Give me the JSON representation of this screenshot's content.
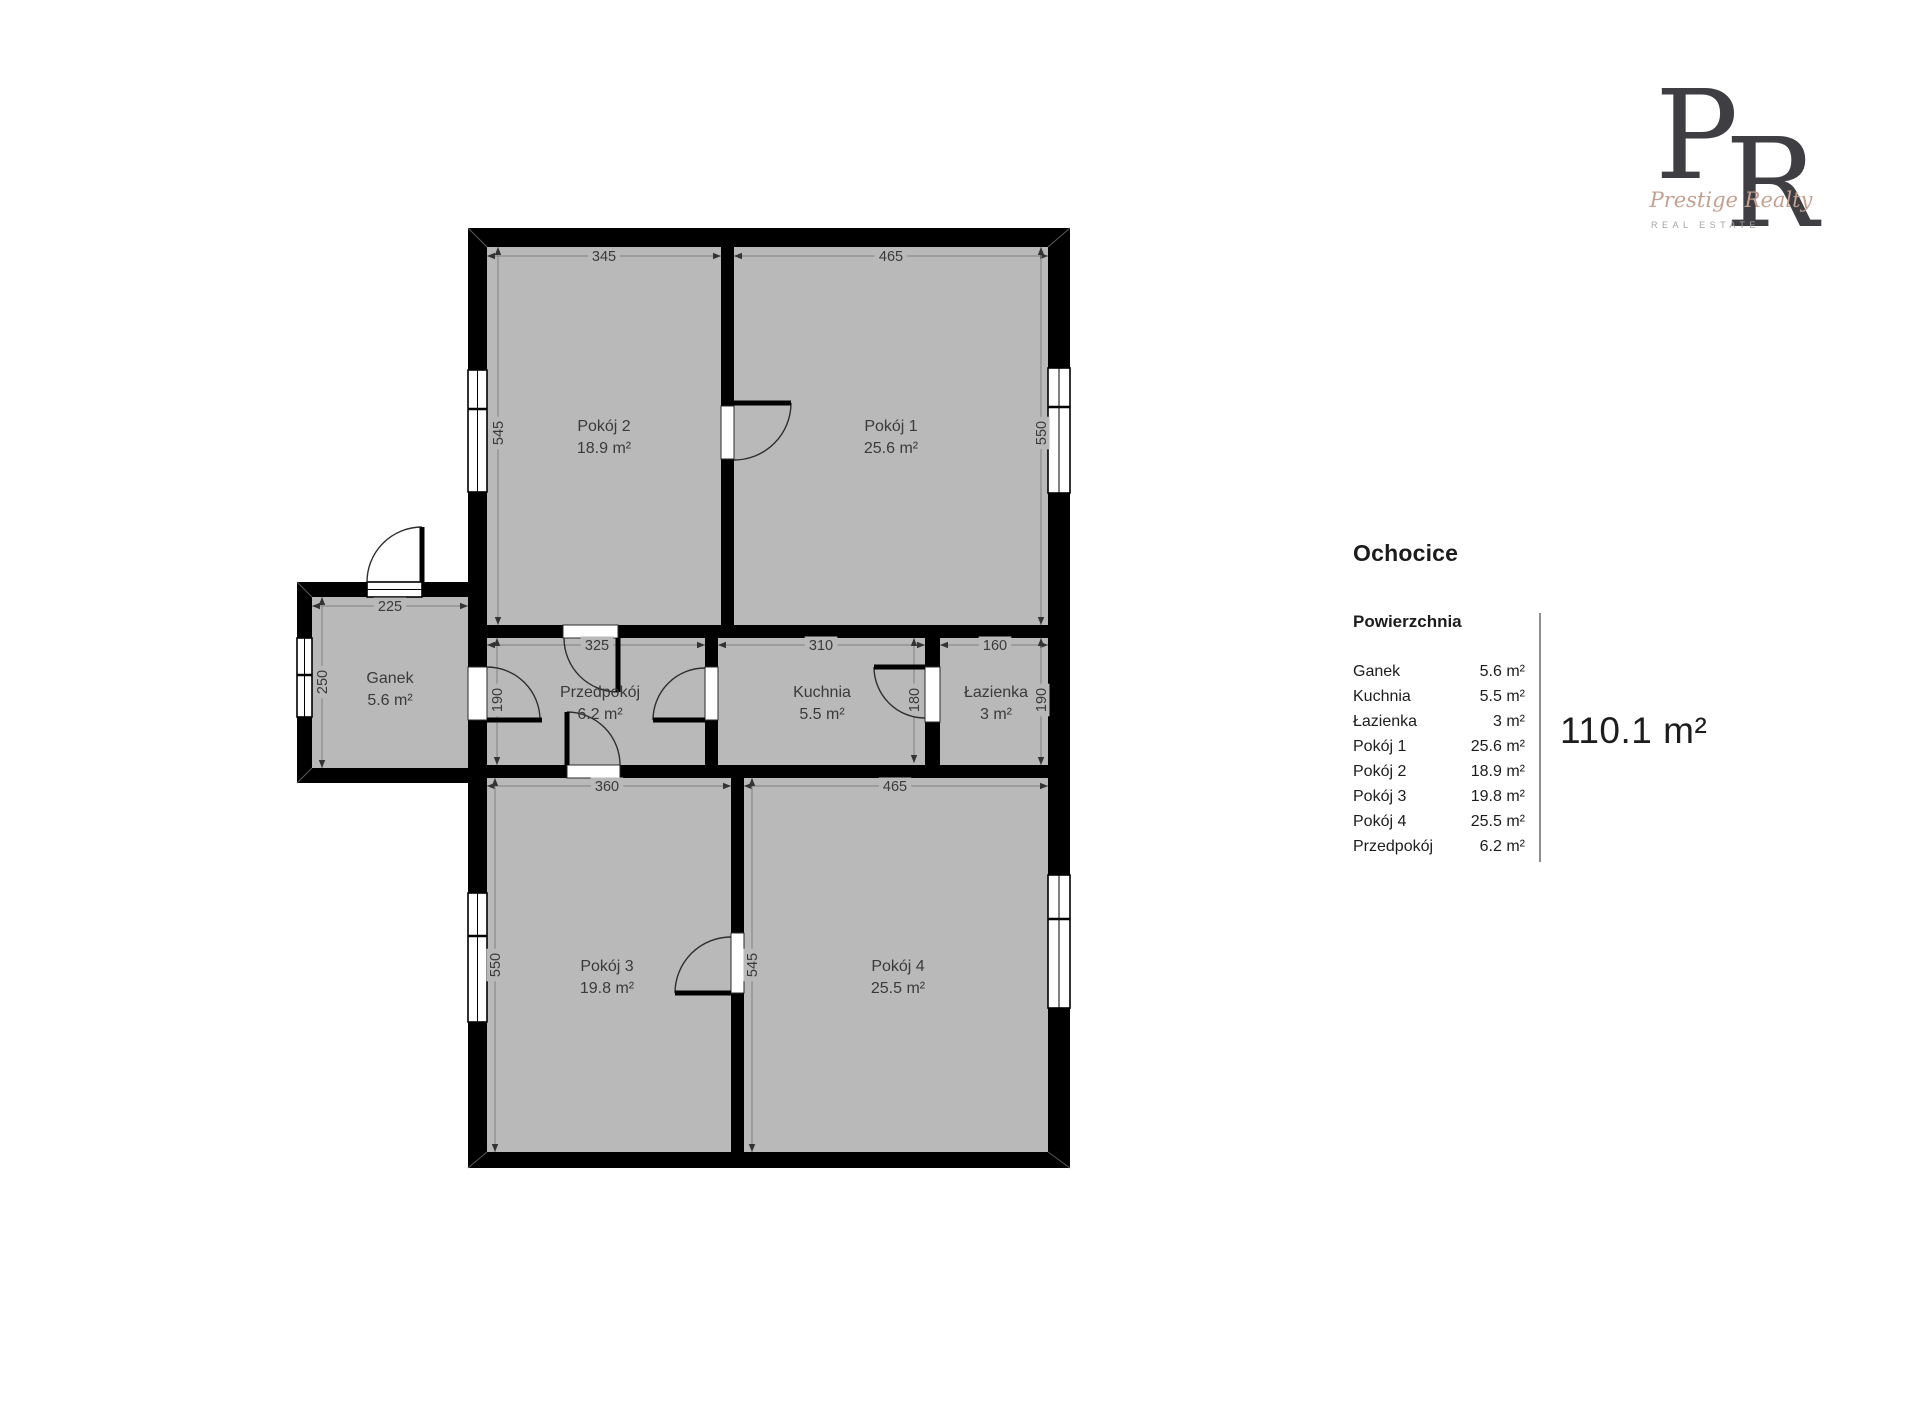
{
  "title": "Ochocice",
  "legend": {
    "heading": "Powierzchnia",
    "rows": [
      {
        "name": "Ganek",
        "area": "5.6 m²"
      },
      {
        "name": "Kuchnia",
        "area": "5.5 m²"
      },
      {
        "name": "Łazienka",
        "area": "3 m²"
      },
      {
        "name": "Pokój 1",
        "area": "25.6 m²"
      },
      {
        "name": "Pokój 2",
        "area": "18.9 m²"
      },
      {
        "name": "Pokój 3",
        "area": "19.8 m²"
      },
      {
        "name": "Pokój 4",
        "area": "25.5 m²"
      },
      {
        "name": "Przedpokój",
        "area": "6.2 m²"
      }
    ],
    "total": "110.1 m²"
  },
  "logo": {
    "letter_p": "P",
    "letter_r": "R",
    "script": "Prestige Realty",
    "subtitle": "REAL ESTATE",
    "letter_color": "#3e3e43",
    "script_color": "#c5a091",
    "subtitle_color": "#a3a3a3"
  },
  "plan": {
    "colors": {
      "wall": "#000000",
      "floor": "#b9b9b9",
      "opening": "#ffffff",
      "dim_line": "#8a8a8a",
      "dim_text": "#3a3a3a",
      "label_text": "#3a3a3a",
      "arc": "#2e2e2e",
      "miter": "#5a5a5a"
    },
    "floors": [
      {
        "x": 487,
        "y": 247,
        "w": 561,
        "h": 905
      },
      {
        "x": 312,
        "y": 597,
        "w": 156,
        "h": 171
      }
    ],
    "walls": [
      {
        "x": 468,
        "y": 228,
        "w": 602,
        "h": 19
      },
      {
        "x": 468,
        "y": 1152,
        "w": 602,
        "h": 16
      },
      {
        "x": 468,
        "y": 228,
        "w": 19,
        "h": 940
      },
      {
        "x": 1048,
        "y": 228,
        "w": 22,
        "h": 940
      },
      {
        "x": 297,
        "y": 582,
        "w": 171,
        "h": 15
      },
      {
        "x": 297,
        "y": 582,
        "w": 15,
        "h": 201
      },
      {
        "x": 297,
        "y": 768,
        "w": 171,
        "h": 15
      },
      {
        "x": 487,
        "y": 625,
        "w": 561,
        "h": 13
      },
      {
        "x": 487,
        "y": 765,
        "w": 561,
        "h": 13
      },
      {
        "x": 721,
        "y": 247,
        "w": 13,
        "h": 378
      },
      {
        "x": 705,
        "y": 638,
        "w": 13,
        "h": 127
      },
      {
        "x": 925,
        "y": 638,
        "w": 15,
        "h": 127
      },
      {
        "x": 731,
        "y": 778,
        "w": 13,
        "h": 374
      }
    ],
    "openings": [
      {
        "x": 721,
        "y": 406,
        "w": 13,
        "h": 53
      },
      {
        "x": 563,
        "y": 625,
        "w": 55,
        "h": 13
      },
      {
        "x": 567,
        "y": 765,
        "w": 53,
        "h": 13
      },
      {
        "x": 705,
        "y": 667,
        "w": 13,
        "h": 53
      },
      {
        "x": 925,
        "y": 667,
        "w": 15,
        "h": 55
      },
      {
        "x": 731,
        "y": 933,
        "w": 13,
        "h": 60
      },
      {
        "x": 468,
        "y": 667,
        "w": 19,
        "h": 53
      }
    ],
    "windows": [
      {
        "x": 468,
        "y": 370,
        "w": 19,
        "h": 122,
        "orient": "v",
        "dividers": [
          409
        ]
      },
      {
        "x": 1048,
        "y": 368,
        "w": 22,
        "h": 125,
        "orient": "v",
        "dividers": [
          407
        ]
      },
      {
        "x": 468,
        "y": 893,
        "w": 19,
        "h": 129,
        "orient": "v",
        "dividers": [
          936
        ]
      },
      {
        "x": 1048,
        "y": 875,
        "w": 22,
        "h": 133,
        "orient": "v",
        "dividers": [
          919
        ]
      },
      {
        "x": 297,
        "y": 638,
        "w": 15,
        "h": 79,
        "orient": "v",
        "dividers": [
          675
        ]
      },
      {
        "x": 367,
        "y": 582,
        "w": 55,
        "h": 15,
        "orient": "h",
        "dividers": []
      }
    ],
    "doors": [
      {
        "leaf": [
          734,
          403,
          791,
          403
        ],
        "arc": {
          "cx": 734,
          "cy": 403,
          "r": 57,
          "a0": 0,
          "a1": 90
        }
      },
      {
        "leaf": [
          618,
          638,
          618,
          692
        ],
        "arc": {
          "cx": 618,
          "cy": 638,
          "r": 54,
          "a0": 90,
          "a1": 180
        }
      },
      {
        "leaf": [
          567,
          765,
          567,
          712
        ],
        "arc": {
          "cx": 567,
          "cy": 765,
          "r": 53,
          "a0": 270,
          "a1": 360
        }
      },
      {
        "leaf": [
          705,
          720,
          653,
          720
        ],
        "arc": {
          "cx": 705,
          "cy": 720,
          "r": 52,
          "a0": 180,
          "a1": 270
        }
      },
      {
        "leaf": [
          925,
          667,
          874,
          667
        ],
        "arc": {
          "cx": 925,
          "cy": 667,
          "r": 51,
          "a0": 90,
          "a1": 180
        }
      },
      {
        "leaf": [
          731,
          993,
          675,
          993
        ],
        "arc": {
          "cx": 731,
          "cy": 993,
          "r": 56,
          "a0": 180,
          "a1": 270
        }
      },
      {
        "leaf": [
          422,
          582,
          422,
          527
        ],
        "arc": {
          "cx": 422,
          "cy": 582,
          "r": 55,
          "a0": 180,
          "a1": 270
        }
      },
      {
        "leaf": [
          487,
          720,
          542,
          720
        ],
        "arc": {
          "cx": 487,
          "cy": 720,
          "r": 53,
          "a0": 270,
          "a1": 360
        }
      }
    ],
    "miters": [
      {
        "x1": 468,
        "y1": 228,
        "x2": 487,
        "y2": 247
      },
      {
        "x1": 1070,
        "y1": 228,
        "x2": 1048,
        "y2": 247
      },
      {
        "x1": 468,
        "y1": 1168,
        "x2": 487,
        "y2": 1152
      },
      {
        "x1": 1070,
        "y1": 1168,
        "x2": 1048,
        "y2": 1152
      },
      {
        "x1": 297,
        "y1": 582,
        "x2": 312,
        "y2": 597
      },
      {
        "x1": 297,
        "y1": 783,
        "x2": 312,
        "y2": 768
      }
    ],
    "dims": [
      {
        "label": "345",
        "orient": "h",
        "y": 256,
        "from": 487,
        "to": 721,
        "lx": 604
      },
      {
        "label": "465",
        "orient": "h",
        "y": 256,
        "from": 734,
        "to": 1048,
        "lx": 891
      },
      {
        "label": "225",
        "orient": "h",
        "y": 606,
        "from": 312,
        "to": 468,
        "lx": 390
      },
      {
        "label": "325",
        "orient": "h",
        "y": 645,
        "from": 487,
        "to": 705,
        "lx": 597
      },
      {
        "label": "310",
        "orient": "h",
        "y": 645,
        "from": 718,
        "to": 925,
        "lx": 821
      },
      {
        "label": "160",
        "orient": "h",
        "y": 645,
        "from": 940,
        "to": 1048,
        "lx": 995
      },
      {
        "label": "360",
        "orient": "h",
        "y": 786,
        "from": 487,
        "to": 731,
        "lx": 607
      },
      {
        "label": "465",
        "orient": "h",
        "y": 786,
        "from": 744,
        "to": 1048,
        "lx": 895
      },
      {
        "label": "545",
        "orient": "v",
        "x": 498,
        "from": 247,
        "to": 625,
        "ly": 433
      },
      {
        "label": "550",
        "orient": "v",
        "x": 1041,
        "from": 247,
        "to": 625,
        "ly": 433
      },
      {
        "label": "250",
        "orient": "v",
        "x": 322,
        "from": 597,
        "to": 768,
        "ly": 682
      },
      {
        "label": "190",
        "orient": "v",
        "x": 497,
        "from": 638,
        "to": 765,
        "ly": 700
      },
      {
        "label": "180",
        "orient": "v",
        "x": 914,
        "from": 638,
        "to": 763,
        "ly": 700
      },
      {
        "label": "190",
        "orient": "v",
        "x": 1041,
        "from": 638,
        "to": 765,
        "ly": 700
      },
      {
        "label": "550",
        "orient": "v",
        "x": 495,
        "from": 778,
        "to": 1152,
        "ly": 965
      },
      {
        "label": "545",
        "orient": "v",
        "x": 752,
        "from": 778,
        "to": 1152,
        "ly": 965
      }
    ],
    "room_labels": [
      {
        "name": "Pokój 2",
        "area": "18.9 m²",
        "x": 604,
        "y": 431
      },
      {
        "name": "Pokój 1",
        "area": "25.6 m²",
        "x": 891,
        "y": 431
      },
      {
        "name": "Ganek",
        "area": "5.6 m²",
        "x": 390,
        "y": 683
      },
      {
        "name": "Przedpokój",
        "area": "6.2 m²",
        "x": 600,
        "y": 697
      },
      {
        "name": "Kuchnia",
        "area": "5.5 m²",
        "x": 822,
        "y": 697
      },
      {
        "name": "Łazienka",
        "area": "3 m²",
        "x": 996,
        "y": 697
      },
      {
        "name": "Pokój 3",
        "area": "19.8 m²",
        "x": 607,
        "y": 971
      },
      {
        "name": "Pokój 4",
        "area": "25.5 m²",
        "x": 898,
        "y": 971
      }
    ]
  }
}
